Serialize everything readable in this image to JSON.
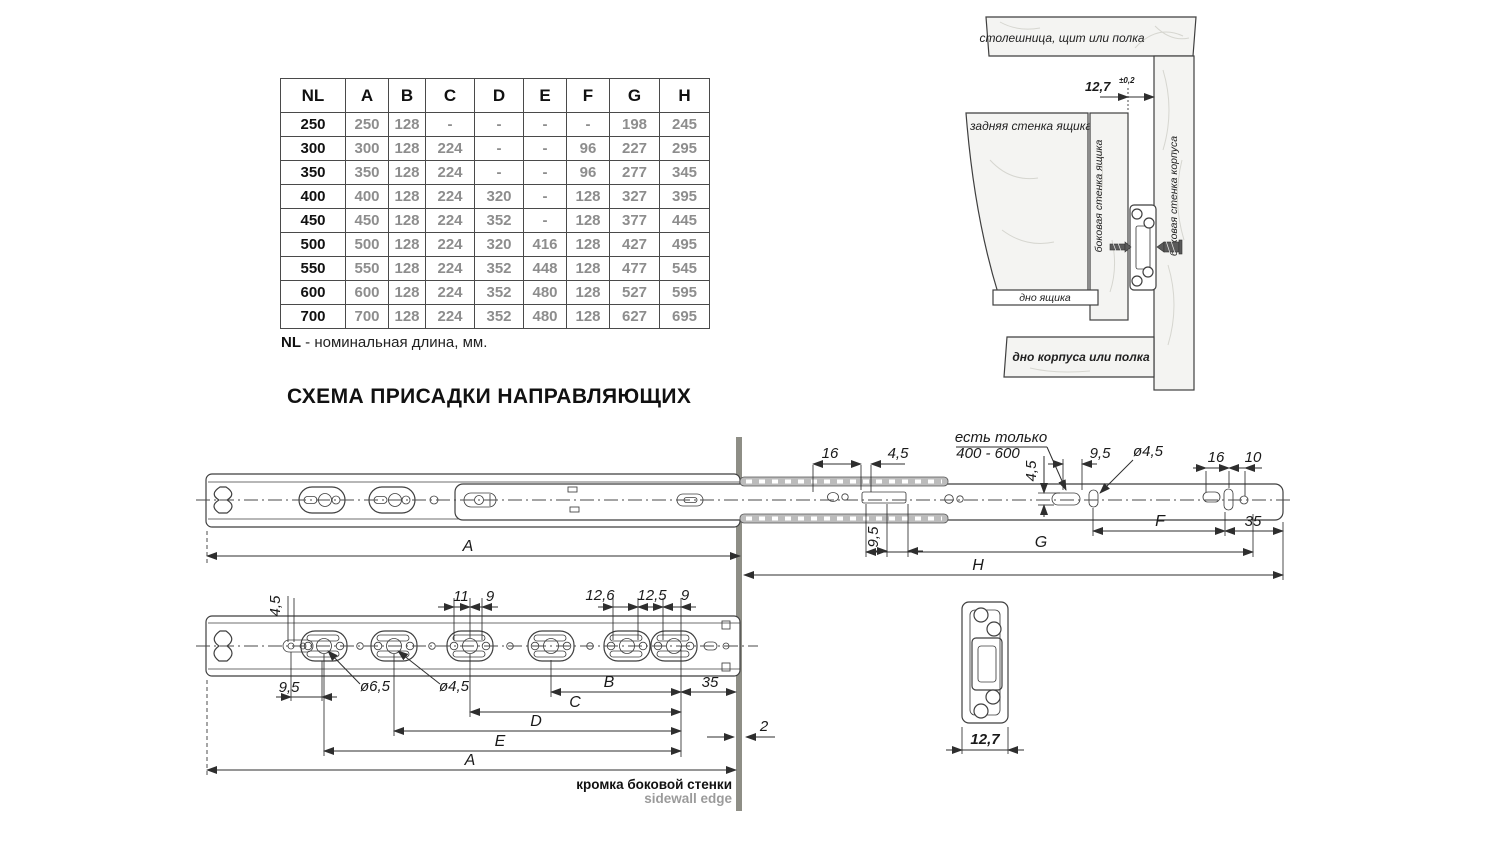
{
  "table": {
    "headers": [
      "NL",
      "A",
      "B",
      "C",
      "D",
      "E",
      "F",
      "G",
      "H"
    ],
    "rows": [
      [
        "250",
        "250",
        "128",
        "-",
        "-",
        "-",
        "-",
        "198",
        "245"
      ],
      [
        "300",
        "300",
        "128",
        "224",
        "-",
        "-",
        "96",
        "227",
        "295"
      ],
      [
        "350",
        "350",
        "128",
        "224",
        "-",
        "-",
        "96",
        "277",
        "345"
      ],
      [
        "400",
        "400",
        "128",
        "224",
        "320",
        "-",
        "128",
        "327",
        "395"
      ],
      [
        "450",
        "450",
        "128",
        "224",
        "352",
        "-",
        "128",
        "377",
        "445"
      ],
      [
        "500",
        "500",
        "128",
        "224",
        "320",
        "416",
        "128",
        "427",
        "495"
      ],
      [
        "550",
        "550",
        "128",
        "224",
        "352",
        "448",
        "128",
        "477",
        "545"
      ],
      [
        "600",
        "600",
        "128",
        "224",
        "352",
        "480",
        "128",
        "527",
        "595"
      ],
      [
        "700",
        "700",
        "128",
        "224",
        "352",
        "480",
        "128",
        "627",
        "695"
      ]
    ],
    "footnote": {
      "prefix": "NL",
      "text": " - номинальная длина, мм."
    }
  },
  "heading": "СХЕМА ПРИСАДКИ НАПРАВЛЯЮЩИХ",
  "inset": {
    "countertop": "столешница, щит или полка",
    "gap_value": "12,7",
    "gap_tolerance": "±0,2",
    "drawer_back": "задняя стенка ящика",
    "drawer_side": "боковая стенка ящика",
    "cabinet_side": "боковая стенка корпуса",
    "drawer_bottom": "дно ящика",
    "cabinet_bottom": "дно корпуса или полка"
  },
  "top_view": {
    "a": "A",
    "d16l": "16",
    "d45l": "4,5",
    "d95l": "9,5",
    "note1": "есть только",
    "note2": "400 - 600",
    "d45r": "4,5",
    "d95r": "9,5",
    "dia45": "ø4,5",
    "d16r": "16",
    "d10": "10",
    "f": "F",
    "d35": "35",
    "g": "G",
    "h": "H"
  },
  "front_view": {
    "d45": "4,5",
    "d11": "11",
    "d9a": "9",
    "d126": "12,6",
    "d125": "12,5",
    "d9b": "9",
    "d95": "9,5",
    "dia65": "ø6,5",
    "dia45": "ø4,5",
    "b": "B",
    "d35": "35",
    "c": "C",
    "d": "D",
    "e": "E",
    "a": "A",
    "d2": "2",
    "edge_ru": "кромка боковой стенки",
    "edge_en": "sidewall edge"
  },
  "section_view": {
    "width": "12,7"
  },
  "colors": {
    "line": "#3f3f3f",
    "value_gray": "#8d8d8d",
    "edge_gray": "#8e8e86",
    "metal_gray": "#bcbcbc"
  }
}
